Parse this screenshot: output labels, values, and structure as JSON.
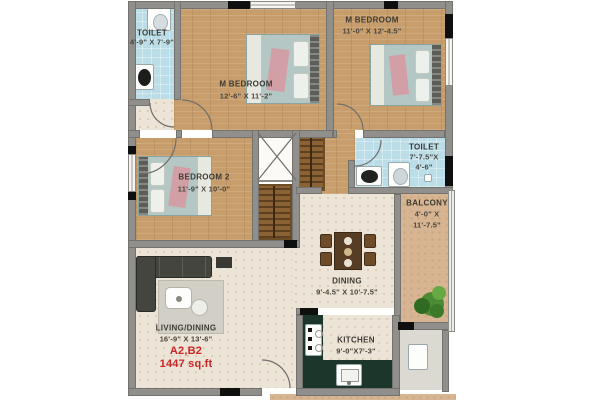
{
  "unit": {
    "code": "A2,B2",
    "area": "1447 sq.ft"
  },
  "rooms": {
    "toilet_top": {
      "name": "TOILET",
      "dims": "4'-9\" X 7'-9\""
    },
    "m_bedroom_left": {
      "name": "M BEDROOM",
      "dims": "12'-6\" X 11'-2\""
    },
    "m_bedroom_right": {
      "name": "M BEDROOM",
      "dims": "11'-0\" X 12'-4.5\""
    },
    "bedroom_2": {
      "name": "BEDROOM 2",
      "dims": "11'-9\" X 10'-0\""
    },
    "toilet_right": {
      "name": "TOILET",
      "dims_line1": "7'-7.5\"X",
      "dims_line2": "4'-6\""
    },
    "balcony": {
      "name": "BALCONY",
      "dims_line1": "4'-0\" X",
      "dims_line2": "11'-7.5\""
    },
    "dining": {
      "name": "DINING",
      "dims": "9'-4.5\" X 10'-7.5\""
    },
    "living_dining": {
      "name": "LIVING/DINING",
      "dims": "16'-9\" X 13'-6\""
    },
    "kitchen": {
      "name": "KITCHEN",
      "dims": "9'-0\"X7'-3\""
    }
  },
  "colors": {
    "accent_red": "#cc2525",
    "wood_floor": "#c79e6b",
    "toilet_blue": "#badde8",
    "balcony_tan": "#d7b592",
    "floor_cream": "#ece4d6",
    "counter_green": "#1d362c",
    "wall_gray": "#908f8b"
  }
}
